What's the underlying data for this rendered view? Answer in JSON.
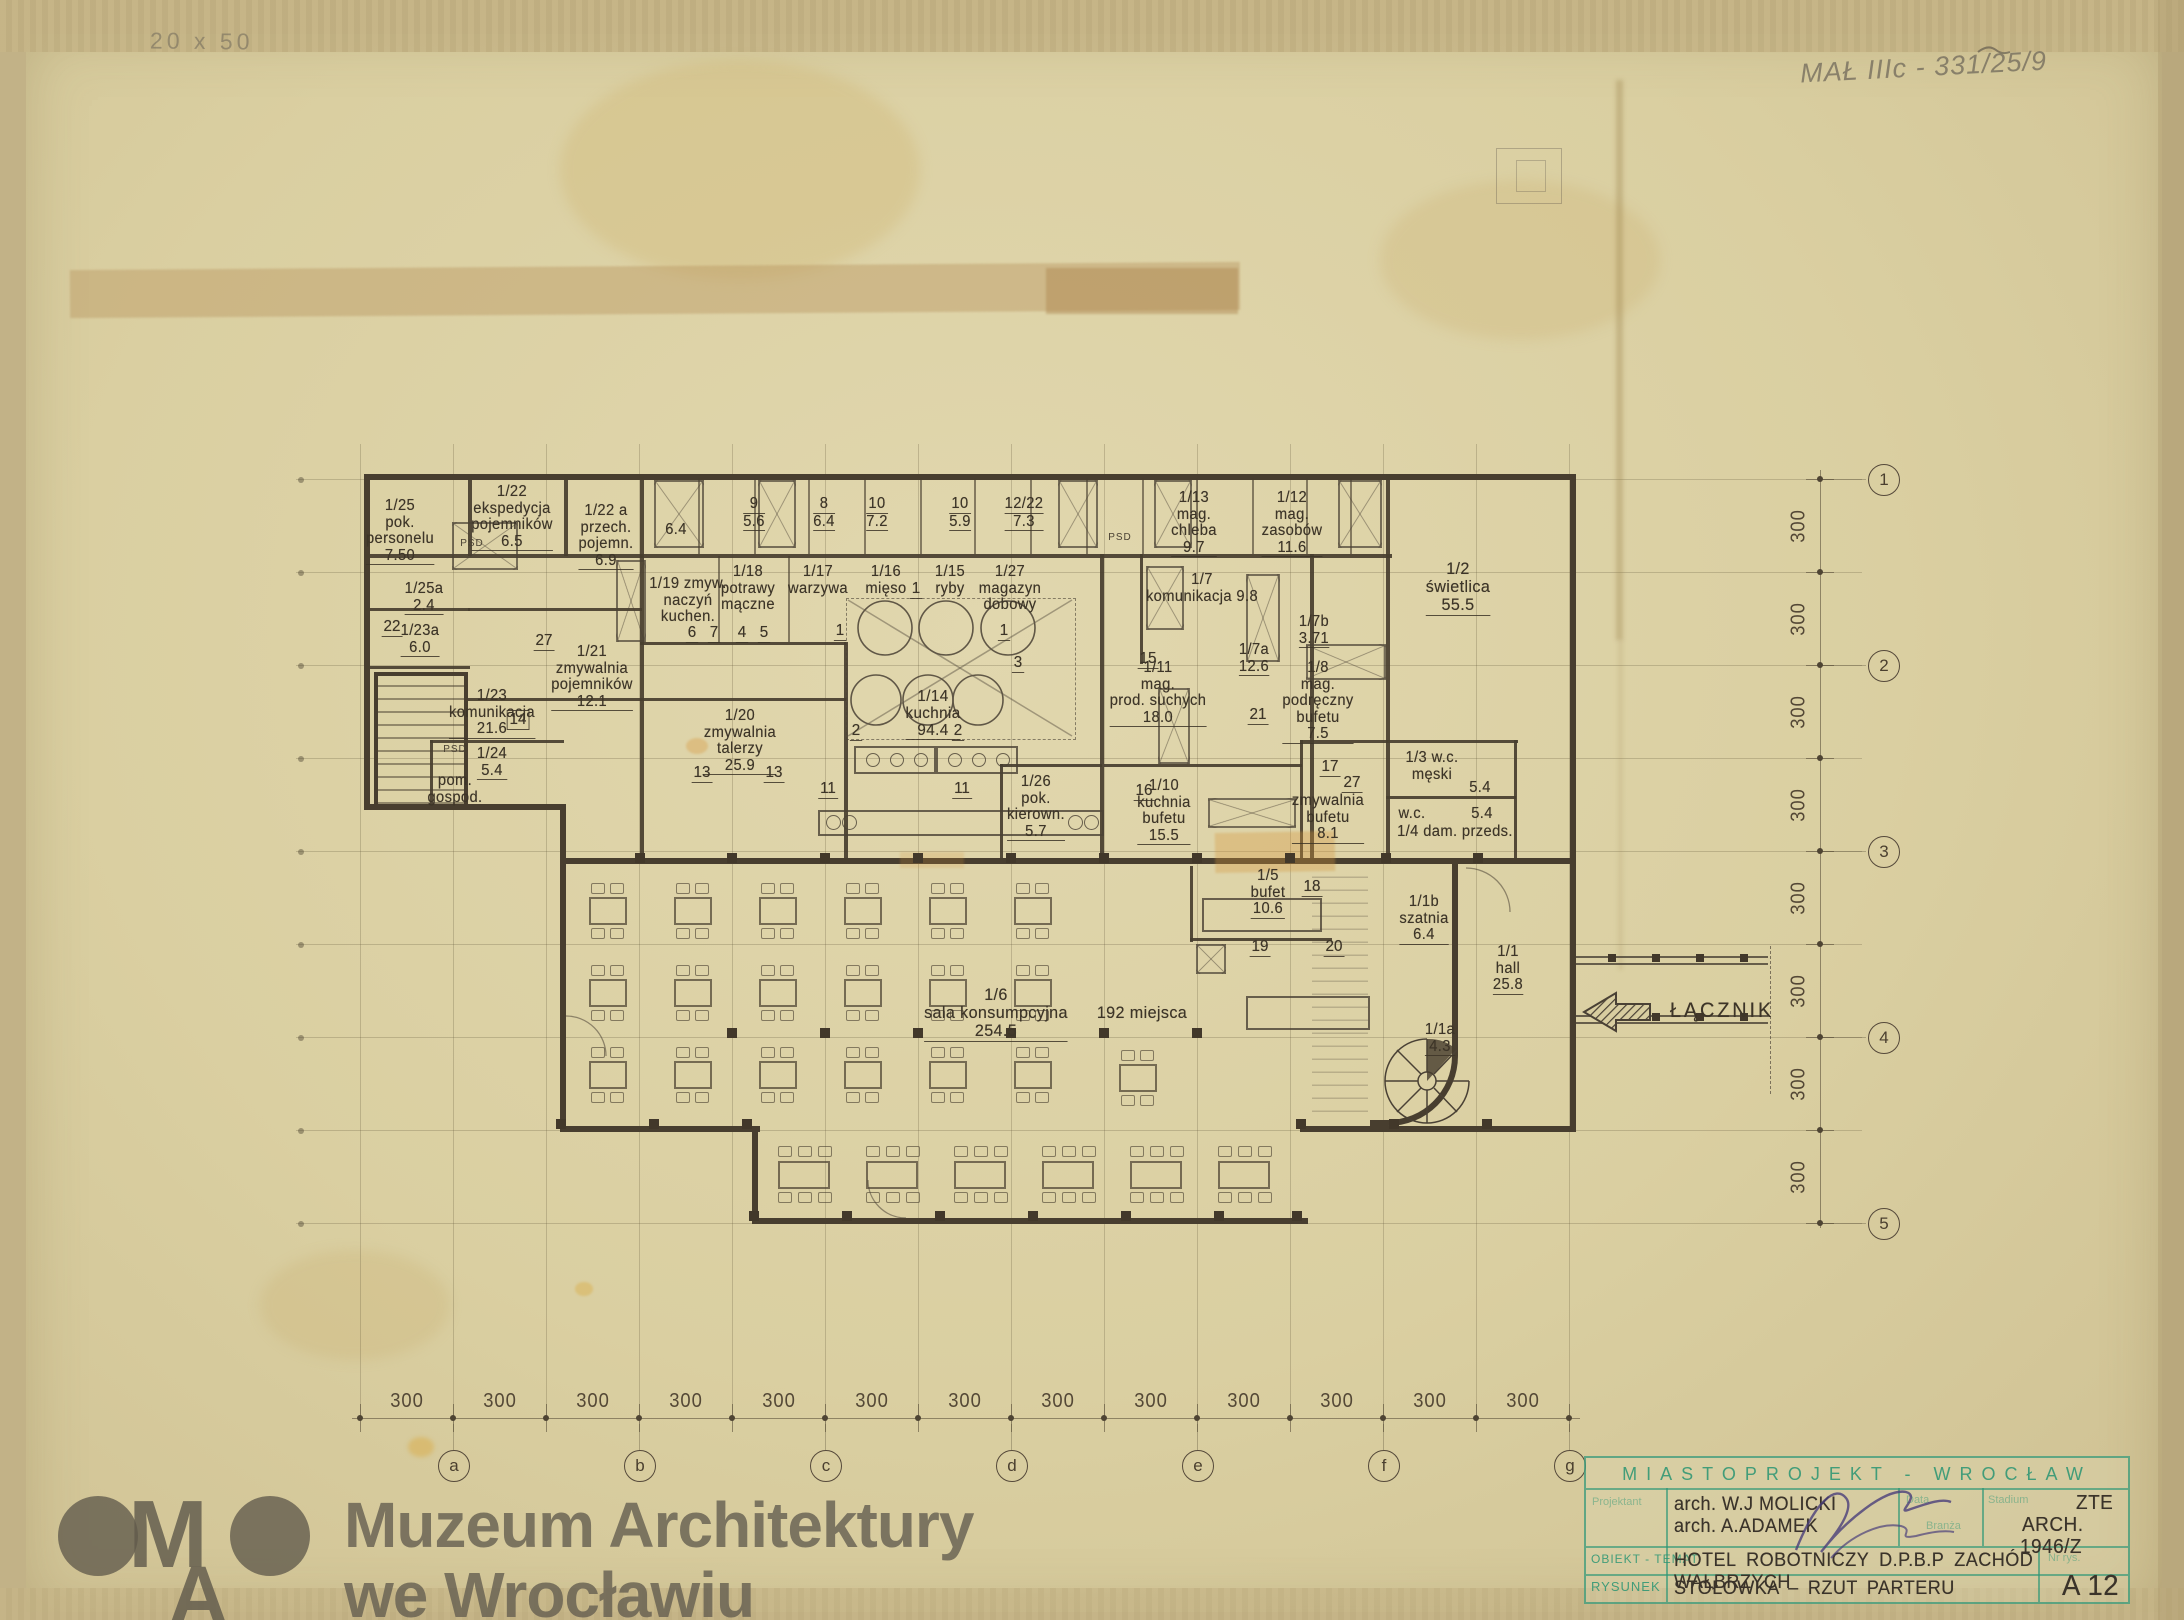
{
  "scan": {
    "pencil_note_top_left": "20 x 50",
    "pencil_note_top_right": "MAŁ IIIc - 331/25/9"
  },
  "watermark": {
    "logo_m": "M",
    "logo_a": "A",
    "line1": "Muzeum Architektury",
    "line2": "we Wrocławiu"
  },
  "plan": {
    "connector_label": "ŁĄCZNIK",
    "psd_labels": [
      {
        "t": "PSD",
        "x": 472,
        "y": 538
      },
      {
        "t": "PSD",
        "x": 1120,
        "y": 532
      },
      {
        "t": "PSD",
        "x": 455,
        "y": 744
      }
    ],
    "rooms": [
      {
        "lines": [
          "1/25",
          "pok.",
          "personelu",
          "7.50"
        ],
        "x": 400,
        "y": 498
      },
      {
        "lines": [
          "1/25a",
          "2.4"
        ],
        "x": 424,
        "y": 581
      },
      {
        "lines": [
          "1/23a",
          "6.0"
        ],
        "x": 420,
        "y": 623
      },
      {
        "lines": [
          "1/22",
          "ekspedycja",
          "pojemników",
          "6.5"
        ],
        "x": 512,
        "y": 484
      },
      {
        "lines": [
          "1/22 a",
          "przech.",
          "pojemn.",
          "6.9"
        ],
        "x": 606,
        "y": 503
      },
      {
        "lines": [
          "1/23",
          "komunikacja",
          "21.6"
        ],
        "x": 492,
        "y": 688
      },
      {
        "lines": [
          "1/21",
          "zmywalnia",
          "pojemników",
          "12.1"
        ],
        "x": 592,
        "y": 644
      },
      {
        "lines": [
          "1/24",
          "5.4"
        ],
        "x": 492,
        "y": 746
      },
      {
        "lines": [
          "pom.",
          "gospod."
        ],
        "x": 455,
        "y": 773
      },
      {
        "lines": [
          "1/19 zmyw.",
          "naczyń",
          "kuchen."
        ],
        "x": 688,
        "y": 576
      },
      {
        "lines": [
          "1/18",
          "potrawy",
          "mączne"
        ],
        "x": 748,
        "y": 564
      },
      {
        "lines": [
          "1/17",
          "warzywa"
        ],
        "x": 818,
        "y": 564
      },
      {
        "lines": [
          "1/16",
          "mięso"
        ],
        "x": 886,
        "y": 564
      },
      {
        "lines": [
          "1/15",
          "ryby"
        ],
        "x": 950,
        "y": 564
      },
      {
        "lines": [
          "1/27",
          "magazyn",
          "dobowy"
        ],
        "x": 1010,
        "y": 564
      },
      {
        "lines": [
          "9",
          "5.6"
        ],
        "x": 754,
        "y": 496,
        "u": true
      },
      {
        "lines": [
          "8",
          "6.4"
        ],
        "x": 824,
        "y": 496,
        "u": true
      },
      {
        "lines": [
          "10",
          "7.2"
        ],
        "x": 877,
        "y": 496,
        "u": true
      },
      {
        "lines": [
          "10",
          "5.9"
        ],
        "x": 960,
        "y": 496,
        "u": true
      },
      {
        "lines": [
          "12/22",
          "7.3"
        ],
        "x": 1024,
        "y": 496,
        "u": true
      },
      {
        "lines": [
          "6.4"
        ],
        "x": 676,
        "y": 522
      },
      {
        "lines": [
          "1/13",
          "mag.",
          "chleba",
          "9.7"
        ],
        "x": 1194,
        "y": 490
      },
      {
        "lines": [
          "1/12",
          "mag.",
          "zasobów",
          "11.6"
        ],
        "x": 1292,
        "y": 490
      },
      {
        "lines": [
          "1/7",
          "komunikacja 9.8"
        ],
        "x": 1202,
        "y": 572
      },
      {
        "lines": [
          "1/2",
          "świetlica",
          "55.5"
        ],
        "x": 1458,
        "y": 560,
        "s": 17
      },
      {
        "lines": [
          "1/7b",
          "3.71"
        ],
        "x": 1314,
        "y": 614
      },
      {
        "lines": [
          "1/7a",
          "12.6"
        ],
        "x": 1254,
        "y": 642
      },
      {
        "lines": [
          "1/8",
          "mag.",
          "podręczny",
          "bufetu",
          "7.5"
        ],
        "x": 1318,
        "y": 660
      },
      {
        "lines": [
          "1/11",
          "mag.",
          "prod. suchych",
          "18.0"
        ],
        "x": 1158,
        "y": 660
      },
      {
        "lines": [
          "1/20",
          "zmywalnia",
          "talerzy",
          "25.9"
        ],
        "x": 740,
        "y": 708
      },
      {
        "lines": [
          "1/14",
          "kuchnia",
          "94.4"
        ],
        "x": 933,
        "y": 688,
        "s": 16
      },
      {
        "lines": [
          "1/26",
          "pok.",
          "kierown.",
          "5.7"
        ],
        "x": 1036,
        "y": 774
      },
      {
        "lines": [
          "1/10",
          "kuchnia",
          "bufetu",
          "15.5"
        ],
        "x": 1164,
        "y": 778
      },
      {
        "lines": [
          "zmywalnia",
          "bufetu",
          "8.1"
        ],
        "x": 1328,
        "y": 793
      },
      {
        "lines": [
          "1/3 w.c.",
          "męski"
        ],
        "x": 1432,
        "y": 750
      },
      {
        "lines": [
          "5.4"
        ],
        "x": 1480,
        "y": 780
      },
      {
        "lines": [
          "w.c."
        ],
        "x": 1412,
        "y": 806
      },
      {
        "lines": [
          "5.4"
        ],
        "x": 1482,
        "y": 806
      },
      {
        "lines": [
          "1/4 dam. przeds."
        ],
        "x": 1455,
        "y": 824
      },
      {
        "lines": [
          "1/5",
          "bufet",
          "10.6"
        ],
        "x": 1268,
        "y": 868
      },
      {
        "lines": [
          "1/1b",
          "szatnia",
          "6.4"
        ],
        "x": 1424,
        "y": 894
      },
      {
        "lines": [
          "1/1",
          "hall",
          "25.8"
        ],
        "x": 1508,
        "y": 944
      },
      {
        "lines": [
          "1/6",
          "sala konsumpcyjna",
          "254.5"
        ],
        "x": 996,
        "y": 986,
        "s": 17
      },
      {
        "lines": [
          "192 miejsca"
        ],
        "x": 1142,
        "y": 1004,
        "s": 17
      },
      {
        "lines": [
          "1/1a",
          "4.3"
        ],
        "x": 1440,
        "y": 1022
      }
    ],
    "refs": [
      {
        "n": "22",
        "x": 392,
        "y": 618
      },
      {
        "n": "27",
        "x": 544,
        "y": 632
      },
      {
        "n": "14",
        "x": 518,
        "y": 710,
        "b": true
      },
      {
        "n": "6",
        "x": 692,
        "y": 624
      },
      {
        "n": "7",
        "x": 714,
        "y": 624
      },
      {
        "n": "4",
        "x": 742,
        "y": 624
      },
      {
        "n": "5",
        "x": 764,
        "y": 624
      },
      {
        "n": "1",
        "x": 916,
        "y": 580
      },
      {
        "n": "1",
        "x": 840,
        "y": 622
      },
      {
        "n": "1",
        "x": 1004,
        "y": 622
      },
      {
        "n": "3",
        "x": 1018,
        "y": 654
      },
      {
        "n": "2",
        "x": 856,
        "y": 722
      },
      {
        "n": "2",
        "x": 958,
        "y": 722
      },
      {
        "n": "13",
        "x": 702,
        "y": 764
      },
      {
        "n": "13",
        "x": 774,
        "y": 764
      },
      {
        "n": "11",
        "x": 828,
        "y": 780
      },
      {
        "n": "11",
        "x": 962,
        "y": 780
      },
      {
        "n": "15",
        "x": 1148,
        "y": 650
      },
      {
        "n": "21",
        "x": 1258,
        "y": 706
      },
      {
        "n": "16",
        "x": 1144,
        "y": 782
      },
      {
        "n": "17",
        "x": 1330,
        "y": 758
      },
      {
        "n": "27",
        "x": 1352,
        "y": 774
      },
      {
        "n": "18",
        "x": 1312,
        "y": 878
      },
      {
        "n": "19",
        "x": 1260,
        "y": 938
      },
      {
        "n": "20",
        "x": 1334,
        "y": 938
      }
    ],
    "axes": {
      "bottom_letters": [
        "a",
        "b",
        "c",
        "d",
        "e",
        "f",
        "g"
      ],
      "bottom_dims": [
        "300",
        "300",
        "300",
        "300",
        "300",
        "300",
        "300",
        "300",
        "300",
        "300",
        "300",
        "300",
        "300"
      ],
      "right_numbers": [
        "1",
        "2",
        "3",
        "4",
        "5"
      ],
      "right_dims": [
        "300",
        "300",
        "300",
        "300",
        "300",
        "300",
        "300",
        "300"
      ]
    }
  },
  "title_block": {
    "studio": "MIASTOPROJEKT - WROCŁAW",
    "label_designer": "Projektant",
    "label_object": "OBIEKT - TEMAT",
    "label_drawing": "RYSUNEK",
    "label_date": "Data",
    "label_stage": "Stadium",
    "label_branch": "Branża",
    "label_number": "Nr rys.",
    "designer1": "arch. W.J MOLICKI",
    "designer2": "arch. A.ADAMEK",
    "stage": "ZTE",
    "branch": "ARCH.",
    "code": "1946/Z",
    "object": "HOTEL ROBOTNICZY D.P.B.P ZACHÓD WAŁBRZYCH",
    "drawing": "STOŁÓWKA – RZUT PARTERU",
    "sheet_no": "A 12"
  }
}
